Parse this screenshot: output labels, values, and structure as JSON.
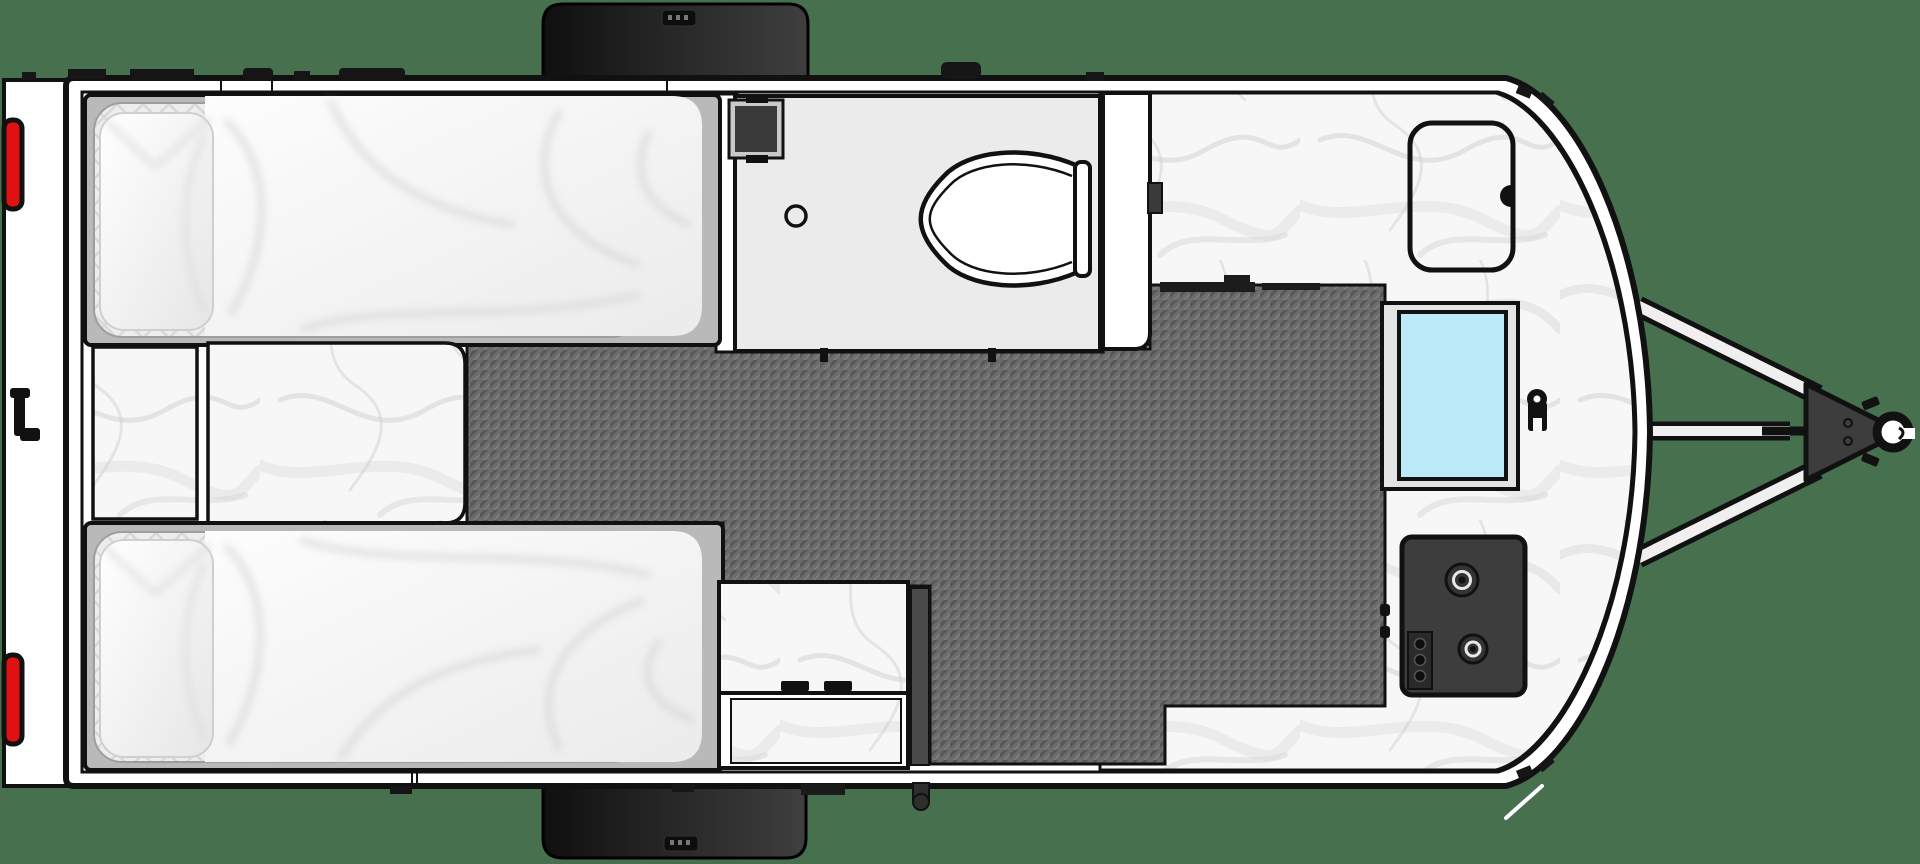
{
  "meta": {
    "label": "Travel trailer floor plan, top-down view",
    "type": "floorplan-diagram"
  },
  "palette": {
    "background": "#47704f",
    "outline": "#111111",
    "hull_white": "#ffffff",
    "floor_gray": "#6c6c6c",
    "floor_weave_dark": "#575757",
    "floor_weave_light": "#7f7f7f",
    "marble_base": "#f7f7f7",
    "marble_vein": "#d4d4d4",
    "wet_bath_gray": "#ebebeb",
    "bed_platform_gray": "#b9b9b9",
    "mattress_quilt": "#ededed",
    "duvet_white": "#fafafa",
    "pillow_white": "#fdfdfd",
    "sink_blue": "#bce9f7",
    "appliance_dark": "#3d3d3d",
    "appliance_black": "#141414",
    "tail_light_red": "#e01111",
    "cabinet_panel_gray": "#4a4a4a",
    "fender_dark": "#1c1c1c",
    "beam_steel": "#efefef"
  },
  "components": {
    "hull": "trailer body shell",
    "rear_bumper": "rear bumper",
    "tail_lights": 2,
    "rear_handle": "rear grab handle",
    "wheel_fenders": 2,
    "tongue": "A-frame tongue",
    "tongue_jack": "tongue jack",
    "coupler": "hitch coupler",
    "hitch_ball_socket": "hitch ball socket",
    "beds": 2,
    "pillows": 2,
    "bedside_cabinet": "bedside cabinet",
    "nightstand": "center nightstand",
    "walkway": "center walkway",
    "floor": "carbon weave floor",
    "wet_bath": "wet bath",
    "toilet": "toilet",
    "shower_drain": "shower drain",
    "vent_fan": "bath vent fan",
    "wardrobe": "wardrobe cabinet",
    "galley_counter": "galley countertop",
    "storage_hatch": "counter storage hatch",
    "sink": "kitchen sink",
    "faucet": "faucet",
    "cooktop": "two-burner cooktop",
    "burners": 2,
    "control_knobs": 3,
    "galley_cabinet": "galley base cabinet",
    "entry_step": "entry step",
    "drain_pipe": "drain outlet"
  }
}
